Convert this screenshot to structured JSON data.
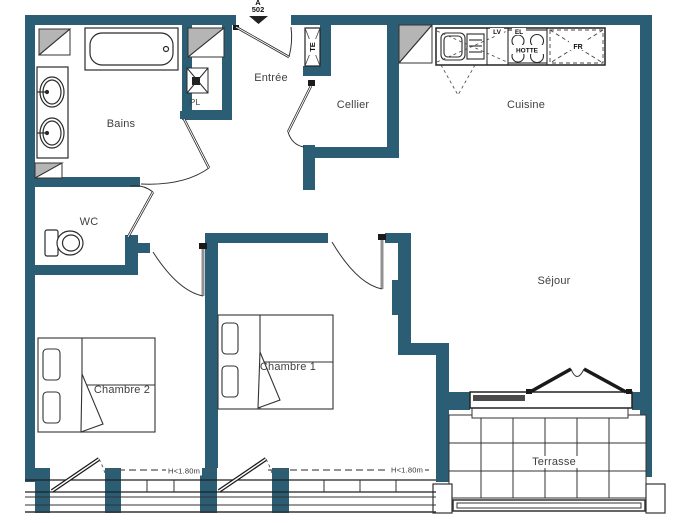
{
  "marker": {
    "building": "A",
    "unit": "502"
  },
  "rooms": {
    "bains": "Bains",
    "wc": "WC",
    "entree": "Entrée",
    "pl": "PL",
    "cellier": "Cellier",
    "cuisine": "Cuisine",
    "sejour": "Séjour",
    "chambre1": "Chambre 1",
    "chambre2": "Chambre 2",
    "terrasse": "Terrasse"
  },
  "appliances": {
    "te": "TE",
    "lv": "LV",
    "el": "EL",
    "hotte": "HOTTE",
    "fr": "FR"
  },
  "annotations": {
    "window_height_notes": [
      "H<1.80m",
      "H<1.80m"
    ]
  },
  "colors": {
    "wall": "#2b5e75",
    "shaft": "#b5b5b5",
    "line": "#2b2b2b",
    "text": "#3f3f3f"
  }
}
